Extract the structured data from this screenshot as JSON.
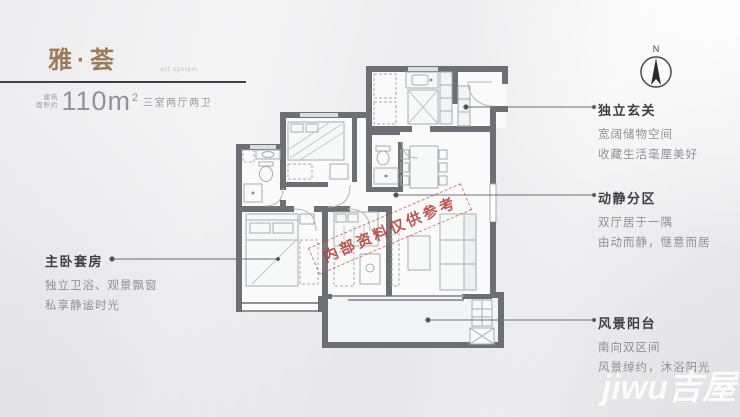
{
  "header": {
    "title": "雅·荟",
    "subtitle": "art system",
    "area_label_top": "建筑",
    "area_label_bottom": "面积约",
    "area_value": "110m",
    "area_unit_sup": "2",
    "layout_text": "三室两厅两卫"
  },
  "compass": {
    "label": "N"
  },
  "plan_watermark": "内部资料仅供参考",
  "brand_watermark": "jiwu吉屋",
  "annotations": {
    "master": {
      "title": "主卧套房",
      "lines": [
        "独立卫浴、观景飘窗",
        "私享静谧时光"
      ]
    },
    "entry": {
      "title": "独立玄关",
      "lines": [
        "宽阔储物空间",
        "收藏生活毫厘美好"
      ]
    },
    "zoning": {
      "title": "动静分区",
      "lines": [
        "双厅居于一隅",
        "由动而静，惬意而居"
      ]
    },
    "balcony": {
      "title": "风景阳台",
      "lines": [
        "南向双区间",
        "风景绰约，沐浴阳光"
      ]
    }
  },
  "colors": {
    "title_brown": "#9b7b5c",
    "wall_gray": "#6e6f74",
    "watermark_red": "#b23b35",
    "annotation_title": "#3e3f42",
    "annotation_body": "#8f9194"
  }
}
